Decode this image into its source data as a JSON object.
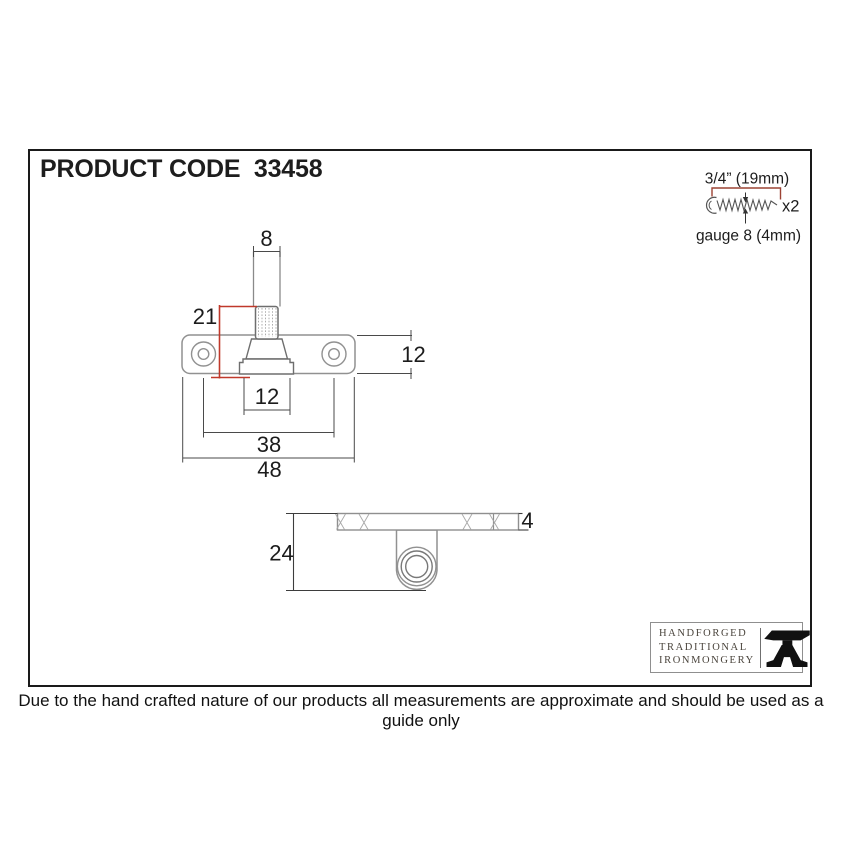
{
  "page": {
    "title": "PRODUCT CODE  33458",
    "footer": "Due to the hand crafted nature of our products all measurements are approximate and should be used as a guide only"
  },
  "screw_spec": {
    "length_label": "3/4” (19mm)",
    "quantity_label": "x2",
    "gauge_label": "gauge 8 (4mm)"
  },
  "dimensions": {
    "top_view": {
      "pin_width": "8",
      "pin_height": "21",
      "plate_height": "12",
      "base_width": "12",
      "hole_spacing": "38",
      "plate_width": "48"
    },
    "side_view": {
      "total_depth": "24",
      "plate_thickness": "4"
    }
  },
  "logo": {
    "line1": "HANDFORGED",
    "line2": "TRADITIONAL",
    "line3": "IRONMONGERY",
    "icon": "anvil-icon"
  },
  "colors": {
    "dimension_accent_red": "#c0392b",
    "screw_bracket_red": "#9c4334",
    "outline_gray": "#919191",
    "dimension_line": "#4a4a4a",
    "text": "#1c1c1c"
  }
}
